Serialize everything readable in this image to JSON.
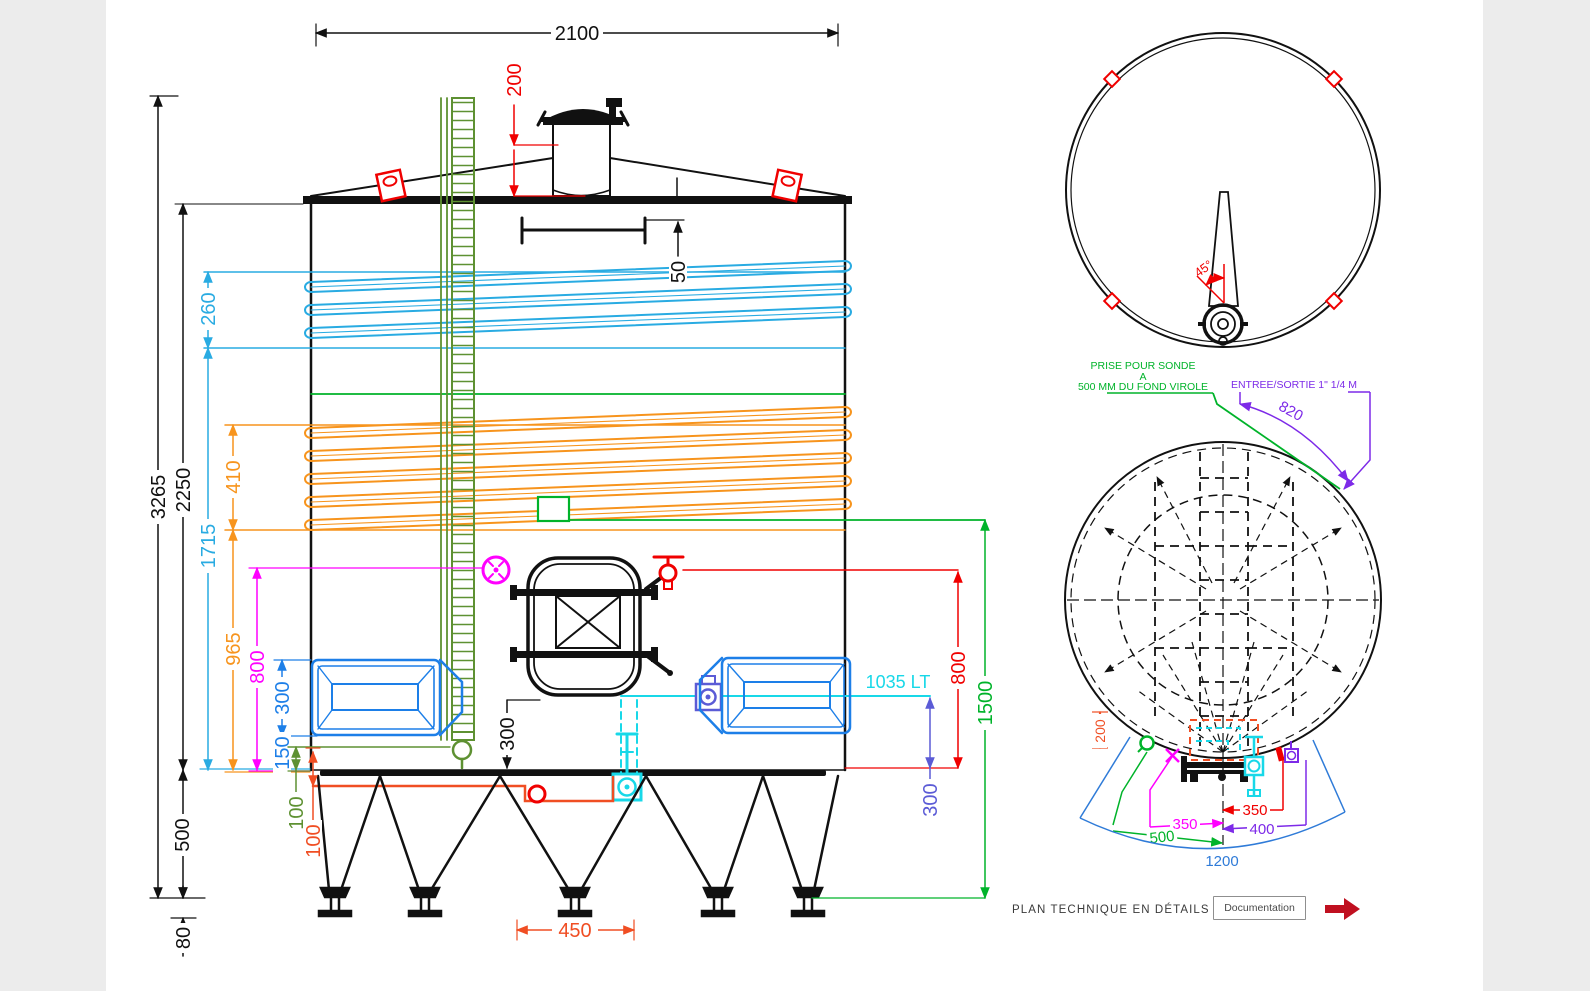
{
  "front_view": {
    "dims": {
      "overall_width": "2100",
      "neck_height": "200",
      "roof_drop": "50",
      "overall_height": "3265",
      "shell_height": "2250",
      "upper_coil_band": "260",
      "upper_coil_level": "1715",
      "mid_coil_band": "410",
      "mid_coil_level": "965",
      "manway_axis": "800",
      "panel_height": "300",
      "panel_level": "150",
      "gauge_offset": "100",
      "drain_offset": "100",
      "legs_height": "500",
      "foot_adjust": "80",
      "outlet_depth": "300",
      "leg_spacing": "450",
      "valve_level": "800",
      "inlet_level": "1500",
      "outlet_level": "300"
    },
    "volume_label": "1035 LT"
  },
  "top_view": {
    "angle_label": "45°"
  },
  "bottom_view": {
    "probe_note": [
      "PRISE POUR SONDE",
      "A",
      "500 MM DU FOND VIROLE"
    ],
    "inlet_note": "ENTREE/SORTIE 1\" 1/4 M",
    "dims": {
      "door_arc": "820",
      "door_depth": "200",
      "offset_right": "350",
      "offset_left": "350",
      "offset_valve": "400",
      "offset_probe": "500",
      "door_swing": "1200"
    }
  },
  "footer": {
    "note": "PLAN TECHNIQUE EN DÉTAILS DANS",
    "doc_button": "Documentation"
  },
  "colors": {
    "red": "#f00000",
    "orange_red": "#f04e23",
    "orange": "#f7941d",
    "coil_cyan": "#29abe2",
    "bright_cyan": "#18d8e8",
    "panel_blue": "#1d7fe8",
    "fan_blue": "#2f7bd8",
    "magenta": "#ff00ff",
    "violet": "#7d2ae8",
    "slate_violet": "#5b5bd6",
    "bright_green": "#00b32a",
    "olive_green": "#5e9132",
    "arrow_dark_red": "#c01020"
  }
}
